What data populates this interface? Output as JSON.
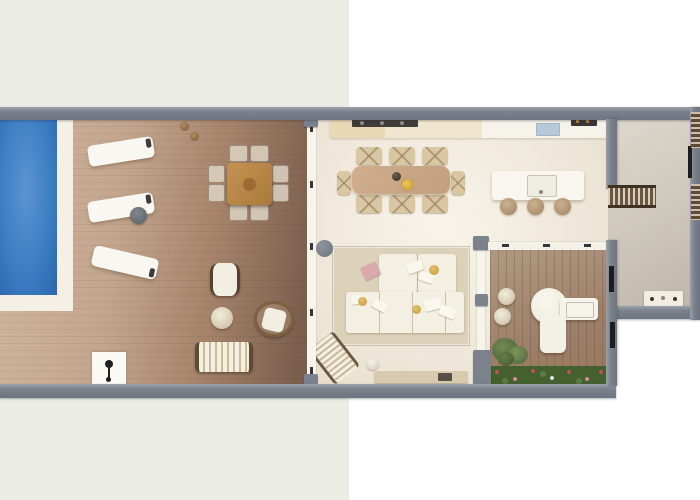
{
  "scene": {
    "type": "floor-plan",
    "description": "Top-down 3D rendered floor plan of a villa suite: pool terrace with loungers and outdoor dining on the left, open-plan kitchen / dining / living room in the middle, private wooden veranda with desk and planting, and an entry hallway with racks on the right.",
    "background_left_color": "#ecece7",
    "background_right_color": "#ffffff"
  },
  "palette": {
    "wall_gray": "#7b828c",
    "pool_water_blue": "#3d7ec3",
    "pool_surround_white": "#f5f0e7",
    "deck_light_tan": "#c3a58d",
    "deck_dark_brown": "#7b5f4d",
    "indoor_floor_cream": "#efe8da",
    "veranda_wood": "#9d8069",
    "hallway_floor_greige": "#d4cdc2",
    "rug_beige": "#dcd2ba",
    "sofa_cream": "#f4efe3",
    "dining_wood": "#c2a07e",
    "outdoor_table_wood": "#b8854a",
    "hedge_green": "#45602f",
    "pillow_gold": "#d8b054",
    "throw_pink": "#d9a9ac",
    "sink_blue": "#b7c9d6",
    "rack_brown": "#5d4932"
  },
  "regions": [
    {
      "name": "pool-terrace",
      "furniture": [
        "swimming pool",
        "3 sun loungers",
        "round drinks table",
        "2 plant pots",
        "square outdoor dining table with 8 chairs",
        "armchair",
        "round pouf",
        "round wicker chair",
        "striped daybed",
        "outdoor shower point"
      ]
    },
    {
      "name": "kitchen-dining",
      "furniture": [
        "wall counter with cooktop, sink and appliances",
        "kitchen island with sink",
        "3 bar stools",
        "dining table for 8 with vase and yellow flowers"
      ]
    },
    {
      "name": "living-room",
      "furniture": [
        "area rug",
        "modular sectional sofa with pillows and pink throw",
        "striped chaise lounge",
        "round side table",
        "media console"
      ]
    },
    {
      "name": "veranda",
      "furniture": [
        "round desk with seat and return",
        "2 round poufs",
        "shrub",
        "flower hedge along facade"
      ]
    },
    {
      "name": "hallway",
      "furniture": [
        "slatted rack",
        "2 wall shelf niches",
        "console with accessories"
      ]
    }
  ],
  "structure": [
    "glass wall between terrace and living area",
    "round structural column",
    "glazed wall to veranda",
    "interior doors shown as dark jambs"
  ]
}
